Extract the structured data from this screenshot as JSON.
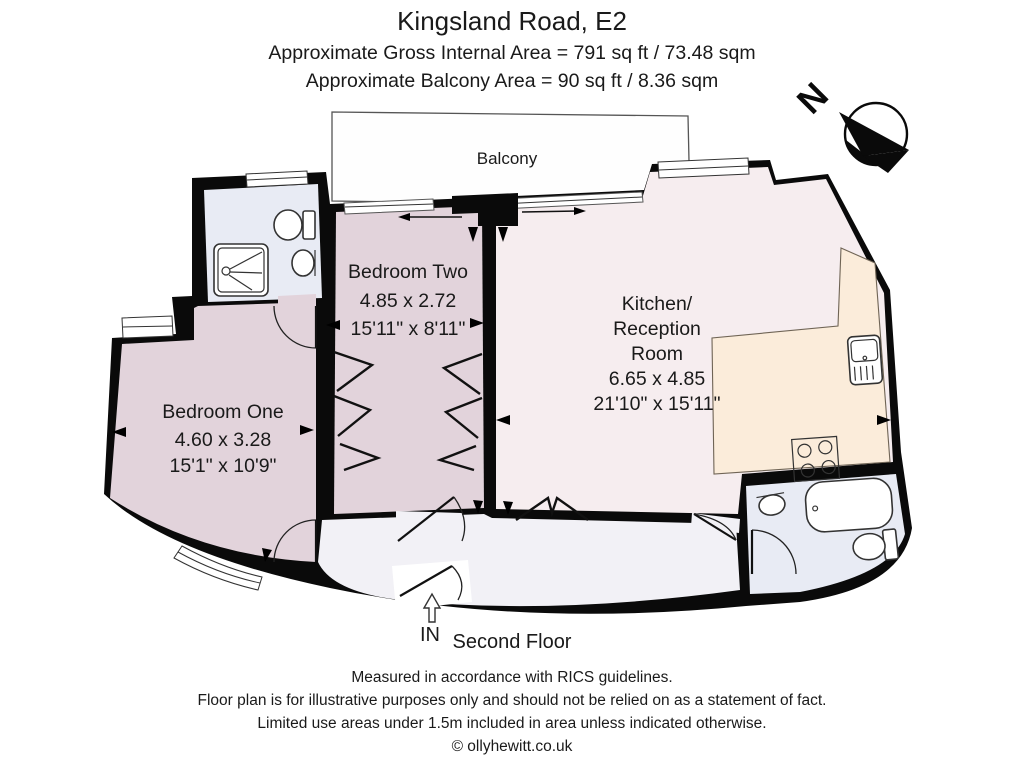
{
  "header": {
    "title": "Kingsland Road, E2",
    "area_line": "Approximate Gross Internal Area = 791 sq ft / 73.48 sqm",
    "balcony_line": "Approximate Balcony Area = 90 sq ft / 8.36 sqm"
  },
  "compass": {
    "label": "N"
  },
  "balcony": {
    "label": "Balcony"
  },
  "rooms": {
    "bedroom_two": {
      "name": "Bedroom Two",
      "metric": "4.85 x 2.72",
      "imperial": "15'11\" x 8'11\""
    },
    "kitchen": {
      "name_lines": [
        "Kitchen/",
        "Reception",
        "Room"
      ],
      "metric": "6.65 x 4.85",
      "imperial": "21'10\" x 15'11\""
    },
    "bedroom_one": {
      "name": "Bedroom One",
      "metric": "4.60 x 3.28",
      "imperial": "15'1\" x 10'9\""
    }
  },
  "entrance": {
    "label": "IN"
  },
  "floor": {
    "label": "Second Floor"
  },
  "footer": {
    "lines": [
      "Measured in accordance with RICS guidelines.",
      "Floor plan is for illustrative purposes only and should not be relied on as a statement of fact.",
      "Limited use areas under 1.5m included in area unless indicated otherwise.",
      "© ollyhewitt.co.uk"
    ]
  },
  "colors": {
    "wall": "#0a0a0a",
    "bedroom": "#e2d3db",
    "reception": "#f6edef",
    "counter": "#fbecda",
    "bathroom": "#e8ebf4",
    "hallway": "#f2f1f6",
    "balcony_fill": "#fefefe"
  }
}
